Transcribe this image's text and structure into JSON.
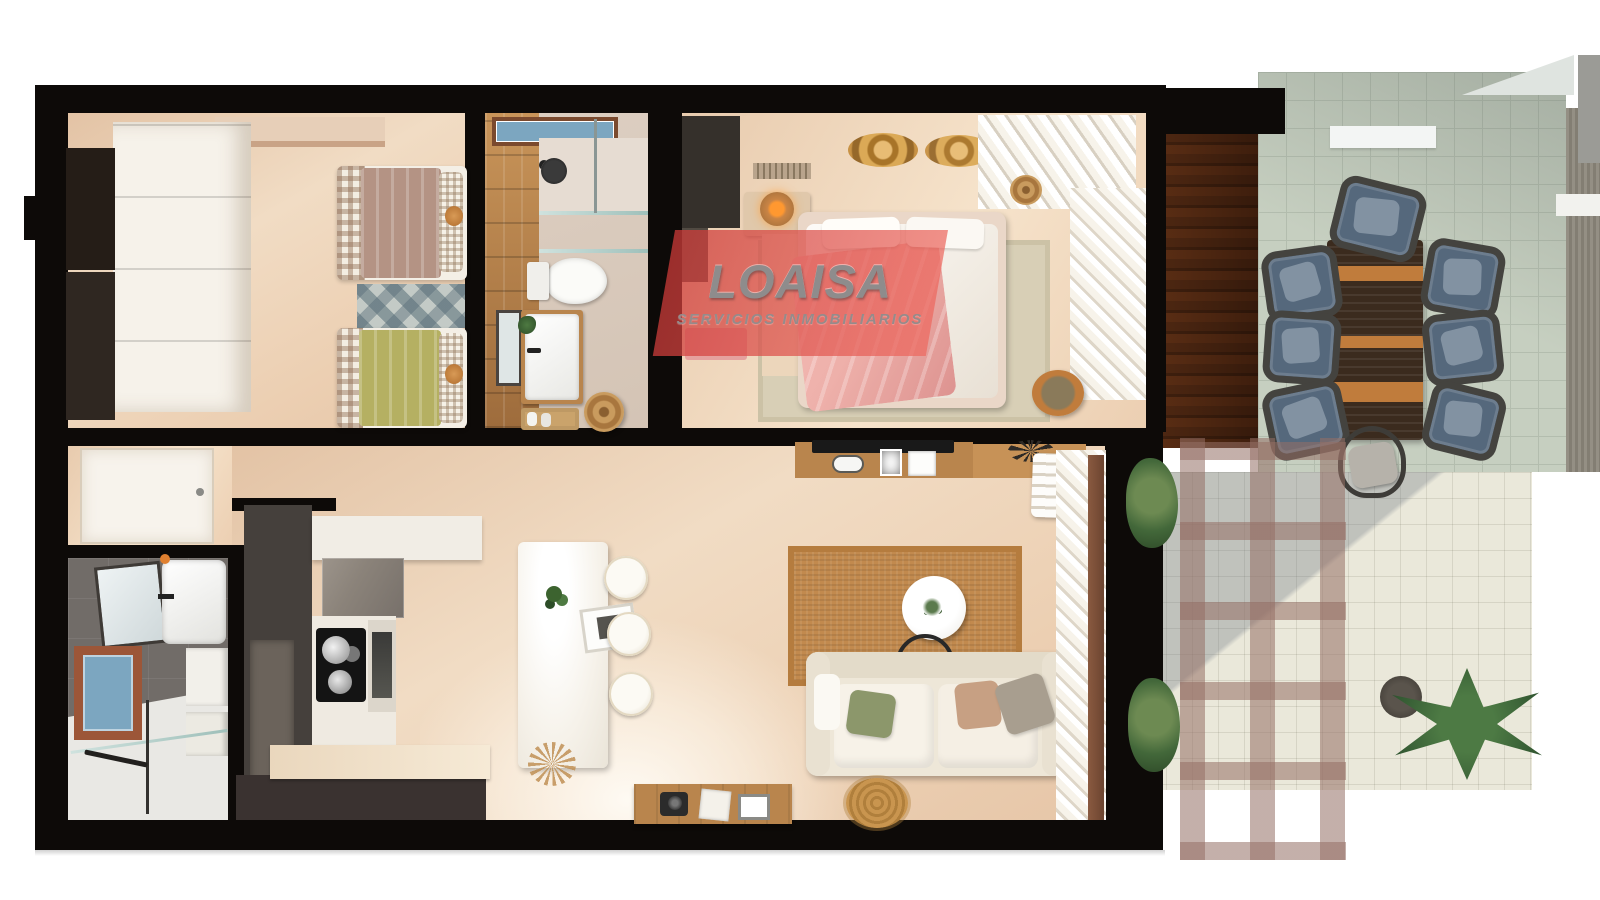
{
  "watermark": {
    "brand": "LOAISA",
    "tagline": "SERVICIOS INMOBILIARIOS"
  },
  "palette": {
    "wall": "#0d0a08",
    "floorWarm": "#ecd2b8",
    "floorBath": "#d9cabc",
    "wood": "#b9854d",
    "woodDark": "#7b4a33",
    "grayWall": "#716c68",
    "whiteFloor": "#e9e8e4",
    "tile": "#c6cfc0",
    "tileLine": "#b3bdae",
    "tileLower": "#eae8da",
    "slat": "#8f6645",
    "pergola": "rgba(148,110,100,0.55)",
    "cabinetDark": "#45403c",
    "taupe": "#8b837a",
    "sofa": "#eee7d8",
    "jute": "#c28a4e",
    "mauve": "#b49384",
    "greenBed": "#b5b062",
    "pinkThrow": "#eeb0aa",
    "chairBlue": "#55687c",
    "chairFrame": "#44433f",
    "tableDark": "#3b2b1e",
    "tableOrange": "#c07c3c",
    "gold": "#c08a3e",
    "glass": "#7ca6c0",
    "terracotta": "#9c5638",
    "plant": "#3e6b3e",
    "wmRed": "rgba(221,72,68,0.72)",
    "wmText": "#8e8c8c"
  }
}
